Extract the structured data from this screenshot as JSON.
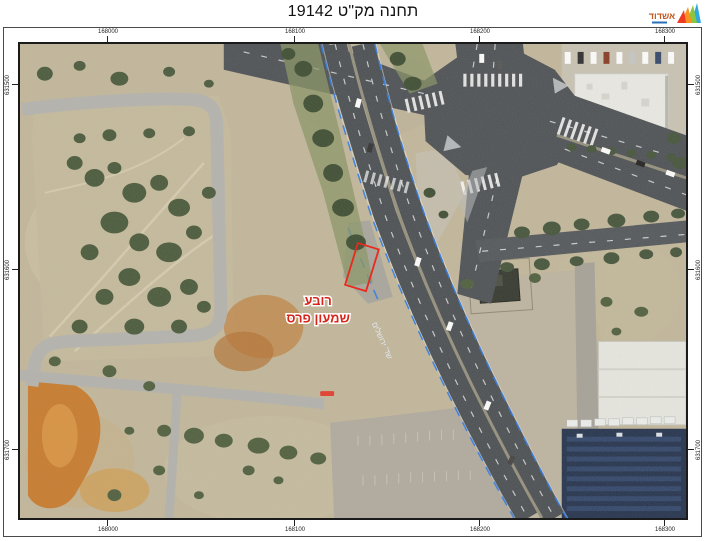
{
  "header": {
    "title": "תחנה מק\"ט 19142",
    "logo_text": "אשדוד"
  },
  "map": {
    "type": "aerial-orthophoto-with-coordinate-grid",
    "grid": {
      "top_labels": [
        "168000",
        "168100",
        "168200",
        "168300"
      ],
      "bottom_labels": [
        "168000",
        "168100",
        "168200",
        "168300"
      ],
      "left_labels": [
        "631500",
        "631600",
        "631700"
      ],
      "right_labels": [
        "631500",
        "631600",
        "631700"
      ]
    },
    "overlays": {
      "district_line1": "רובע",
      "district_line2": "שמעון פרס",
      "street_name": "שד' ירושלים",
      "label_color": "#d8251b",
      "station_marker_color": "#e8291c"
    },
    "palette": {
      "sand": "#c3b89c",
      "asphalt": "#4b5054",
      "vegetation": "#4a5a3c",
      "concrete": "#b2aba0",
      "bike_lane_blue": "#2f7ce6",
      "solar_roof": "#24334e"
    }
  }
}
